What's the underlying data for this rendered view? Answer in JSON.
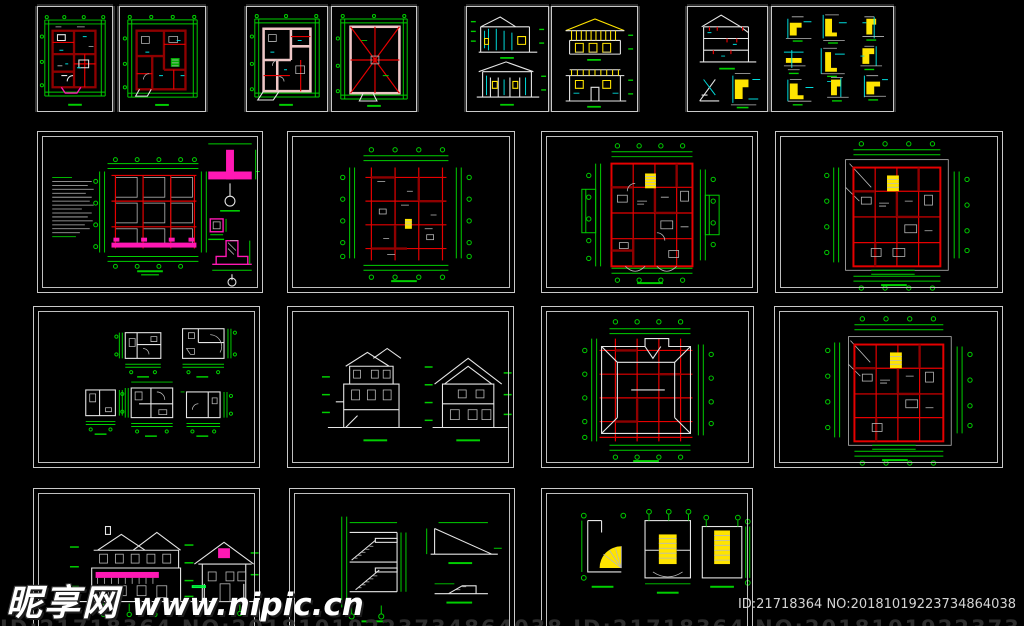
{
  "page": {
    "width": 1024,
    "height": 626,
    "background": "#000000"
  },
  "watermark": {
    "site_name": "昵享网",
    "site_url": "www.nipic.cn"
  },
  "footer": {
    "id_label": "ID:21718364 NO:20181019223734864038",
    "cutoff_line": "ID:21718364 NO:20181019223734864038   ID:21718364 NO:20181019223734864038"
  },
  "palette": {
    "background": "#000000",
    "frame_white": "#c9c9c9",
    "dim_green": "#00cf00",
    "bright_green": "#00ff41",
    "line_red": "#e60000",
    "wall_dark_red": "#8f0000",
    "wall_pink": "#eec6c6",
    "magenta": "#ff18b4",
    "cyan": "#00dcdc",
    "yellow": "#ffe400",
    "white": "#e6e6e6"
  },
  "sheets": [
    {
      "id": "r1-g1-a",
      "label": "Ground floor plan (dark red walls)"
    },
    {
      "id": "r1-g1-b",
      "label": "Upper floor plan (dark red walls)"
    },
    {
      "id": "r1-g2-a",
      "label": "Floor plan (pink walls)"
    },
    {
      "id": "r1-g2-b",
      "label": "Roof plan with hip ridges"
    },
    {
      "id": "r1-g3-a",
      "label": "Two building elevations (cyan and yellow)"
    },
    {
      "id": "r1-g3-b",
      "label": "Two building elevations (yellow)"
    },
    {
      "id": "r1-g4-a",
      "label": "Building section with eave details"
    },
    {
      "id": "r1-g4-b",
      "label": "Construction details sheet"
    },
    {
      "id": "r2-s1",
      "label": "Foundation plan with pink footing details"
    },
    {
      "id": "r2-s2",
      "label": "Structural beam framing plan"
    },
    {
      "id": "r2-s3",
      "label": "Ground floor plan with stair"
    },
    {
      "id": "r2-s4",
      "label": "Second floor plan with stair"
    },
    {
      "id": "r3-s1",
      "label": "Five enlarged bathroom plans"
    },
    {
      "id": "r3-s2",
      "label": "Two building sections"
    },
    {
      "id": "r3-s3",
      "label": "Roof framing plan"
    },
    {
      "id": "r3-s4",
      "label": "Upper floor plan with stair"
    },
    {
      "id": "r4-s1",
      "label": "Front and rear elevations with magenta accents"
    },
    {
      "id": "r4-s2",
      "label": "Stair section and ramp details"
    },
    {
      "id": "r4-s3",
      "label": "Three enlarged stair plans"
    }
  ]
}
